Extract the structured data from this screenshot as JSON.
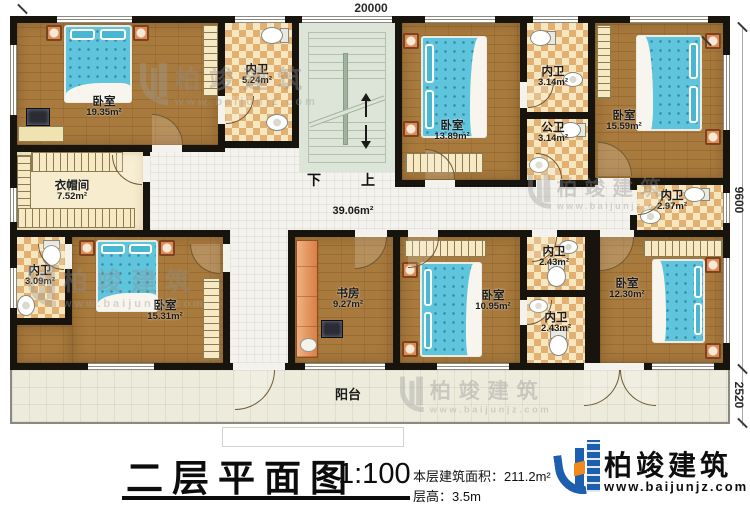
{
  "meta": {
    "drawing_type": "floor-plan"
  },
  "dimensions": {
    "width": "20000",
    "height_main": "9600",
    "height_balcony": "2520"
  },
  "stairs": {
    "down_label": "下",
    "up_label": "上"
  },
  "hall": {
    "area": "39.06m²"
  },
  "balcony": {
    "label": "阳台"
  },
  "watermark": {
    "brand": "柏竣建筑",
    "url": "www.baijunjz.com"
  },
  "title_block": {
    "title": "二层平面图",
    "scale": "1:100",
    "area_line": "本层建筑面积：211.2m²",
    "height_line": "层高：3.5m",
    "brand": "柏竣建筑",
    "brand_url": "www.baijunjz.com"
  },
  "colors": {
    "brand_blue": "#1d5fae",
    "brand_orange": "#f2891f",
    "wall": "#17130d",
    "wood_floor": "#a87a3d"
  },
  "plan": {
    "floors": [
      {
        "c": "whitetile",
        "r": [
          150,
          145,
          487,
          92
        ],
        "n": "hallway-floor"
      },
      {
        "c": "whitetile",
        "r": [
          230,
          237,
          58,
          126
        ],
        "n": "corridor-floor"
      },
      {
        "c": "wood",
        "r": [
          17,
          325,
          55,
          38
        ],
        "n": "bedroom-bl-floor-extension"
      }
    ],
    "rooms": [
      {
        "id": "bedroom-tl",
        "name": "卧室",
        "area": "19.35m²",
        "c": "wood",
        "r": [
          17,
          23,
          201,
          122
        ],
        "lx": 104,
        "ly": 96
      },
      {
        "id": "bath-524",
        "name": "内卫",
        "area": "5.24m²",
        "c": "checker",
        "r": [
          225,
          23,
          67,
          118
        ],
        "lx": 257,
        "ly": 64
      },
      {
        "id": "bedroom-1389",
        "name": "卧室",
        "area": "13.89m²",
        "c": "wood",
        "r": [
          402,
          23,
          118,
          157
        ],
        "lx": 452,
        "ly": 120
      },
      {
        "id": "bath-314-inner",
        "name": "内卫",
        "area": "3.14m²",
        "c": "checker",
        "r": [
          527,
          23,
          61,
          89
        ],
        "lx": 553,
        "ly": 66
      },
      {
        "id": "bath-314-public",
        "name": "公卫",
        "area": "3.14m²",
        "c": "checker",
        "r": [
          527,
          119,
          61,
          61
        ],
        "lx": 553,
        "ly": 122
      },
      {
        "id": "bedroom-1559",
        "name": "卧室",
        "area": "15.59m²",
        "c": "wood",
        "r": [
          595,
          23,
          128,
          155
        ],
        "lx": 624,
        "ly": 110
      },
      {
        "id": "closet",
        "name": "衣帽间",
        "area": "7.52m²",
        "c": "cream",
        "r": [
          17,
          152,
          126,
          78
        ],
        "lx": 72,
        "ly": 180
      },
      {
        "id": "bath-297",
        "name": "内卫",
        "area": "2.97m²",
        "c": "checker",
        "r": [
          637,
          185,
          86,
          45
        ],
        "lx": 672,
        "ly": 190
      },
      {
        "id": "bath-309",
        "name": "内卫",
        "area": "3.09m²",
        "c": "checker",
        "r": [
          17,
          237,
          48,
          81
        ],
        "lx": 40,
        "ly": 265
      },
      {
        "id": "bedroom-1531",
        "name": "卧室",
        "area": "15.31m²",
        "c": "wood",
        "r": [
          72,
          237,
          151,
          126
        ],
        "lx": 165,
        "ly": 300
      },
      {
        "id": "study",
        "name": "书房",
        "area": "9.27m²",
        "c": "wood",
        "r": [
          295,
          237,
          98,
          126
        ],
        "lx": 348,
        "ly": 288
      },
      {
        "id": "bedroom-1095",
        "name": "卧室",
        "area": "10.95m²",
        "c": "wood",
        "r": [
          400,
          237,
          120,
          126
        ],
        "lx": 493,
        "ly": 290
      },
      {
        "id": "bath-243-upper",
        "name": "内卫",
        "area": "2.43m²",
        "c": "checker",
        "r": [
          527,
          237,
          58,
          53
        ],
        "lx": 554,
        "ly": 246
      },
      {
        "id": "bath-243-lower",
        "name": "内卫",
        "area": "2.43m²",
        "c": "checker",
        "r": [
          527,
          297,
          58,
          66
        ],
        "lx": 556,
        "ly": 312
      },
      {
        "id": "bedroom-1230",
        "name": "卧室",
        "area": "12.30m²",
        "c": "wood",
        "r": [
          600,
          237,
          123,
          126
        ],
        "lx": 627,
        "ly": 278
      }
    ],
    "walls": [
      [
        10,
        16,
        720,
        7
      ],
      [
        10,
        363,
        720,
        7
      ],
      [
        10,
        16,
        7,
        354
      ],
      [
        723,
        16,
        7,
        354
      ],
      [
        218,
        16,
        7,
        136
      ],
      [
        292,
        16,
        7,
        131
      ],
      [
        395,
        16,
        7,
        171
      ],
      [
        520,
        16,
        7,
        171
      ],
      [
        588,
        16,
        7,
        171
      ],
      [
        143,
        145,
        7,
        92
      ],
      [
        223,
        230,
        7,
        140
      ],
      [
        288,
        230,
        7,
        140
      ],
      [
        393,
        230,
        7,
        140
      ],
      [
        520,
        230,
        7,
        140
      ],
      [
        585,
        230,
        15,
        140
      ],
      [
        630,
        178,
        7,
        59
      ],
      [
        65,
        237,
        7,
        88
      ],
      [
        10,
        145,
        215,
        7
      ],
      [
        225,
        141,
        74,
        7
      ],
      [
        10,
        230,
        220,
        7
      ],
      [
        288,
        230,
        112,
        7
      ],
      [
        395,
        180,
        132,
        7
      ],
      [
        527,
        112,
        61,
        7
      ],
      [
        527,
        180,
        68,
        7
      ],
      [
        595,
        178,
        135,
        7
      ],
      [
        400,
        230,
        330,
        7
      ],
      [
        527,
        290,
        58,
        7
      ],
      [
        10,
        318,
        62,
        7
      ]
    ],
    "windows": [
      [
        57,
        16,
        75,
        7
      ],
      [
        235,
        16,
        50,
        7
      ],
      [
        302,
        16,
        90,
        7
      ],
      [
        425,
        16,
        70,
        7
      ],
      [
        533,
        16,
        45,
        7
      ],
      [
        630,
        16,
        78,
        7
      ],
      [
        10,
        45,
        7,
        70
      ],
      [
        10,
        188,
        7,
        34
      ],
      [
        10,
        268,
        7,
        40
      ],
      [
        723,
        55,
        7,
        75
      ],
      [
        723,
        193,
        7,
        30
      ],
      [
        723,
        258,
        7,
        85
      ],
      [
        88,
        363,
        66,
        7
      ],
      [
        305,
        363,
        80,
        7
      ],
      [
        437,
        363,
        72,
        7
      ],
      [
        652,
        363,
        62,
        7
      ]
    ],
    "gaps": [
      [
        152,
        145,
        30,
        7
      ],
      [
        143,
        156,
        7,
        26
      ],
      [
        218,
        96,
        7,
        28
      ],
      [
        425,
        180,
        30,
        7
      ],
      [
        520,
        82,
        7,
        26
      ],
      [
        536,
        180,
        24,
        7
      ],
      [
        598,
        178,
        32,
        7
      ],
      [
        630,
        190,
        7,
        25
      ],
      [
        223,
        244,
        7,
        28
      ],
      [
        65,
        244,
        7,
        25
      ],
      [
        355,
        230,
        32,
        7
      ],
      [
        408,
        230,
        30,
        7
      ],
      [
        532,
        230,
        25,
        7
      ],
      [
        520,
        300,
        7,
        25
      ],
      [
        600,
        230,
        34,
        7
      ],
      [
        233,
        363,
        52,
        7
      ],
      [
        584,
        363,
        60,
        7
      ]
    ],
    "arcs": [
      {
        "q": "q-tr",
        "r": [
          152,
          114,
          31,
          31
        ],
        "n": "door-bedroom-tl"
      },
      {
        "q": "q-bl",
        "r": [
          112,
          155,
          30,
          30
        ],
        "n": "door-closet"
      },
      {
        "q": "q-br",
        "r": [
          226,
          96,
          28,
          28
        ],
        "n": "door-bath-524"
      },
      {
        "q": "q-tr",
        "r": [
          425,
          149,
          30,
          30
        ],
        "n": "door-bedroom-1389"
      },
      {
        "q": "q-br",
        "r": [
          528,
          82,
          26,
          26
        ],
        "n": "door-bath-314-inner"
      },
      {
        "q": "q-tr",
        "r": [
          536,
          153,
          26,
          26
        ],
        "n": "door-bath-314-public"
      },
      {
        "q": "q-tr",
        "r": [
          598,
          142,
          34,
          34
        ],
        "n": "door-bedroom-1559"
      },
      {
        "q": "q-br",
        "r": [
          638,
          189,
          26,
          26
        ],
        "n": "door-bath-297"
      },
      {
        "q": "q-bl",
        "r": [
          190,
          244,
          30,
          30
        ],
        "n": "door-bedroom-1531"
      },
      {
        "q": "q-bl",
        "r": [
          38,
          244,
          26,
          26
        ],
        "n": "door-bath-309"
      },
      {
        "q": "q-br",
        "r": [
          355,
          237,
          32,
          32
        ],
        "n": "door-study"
      },
      {
        "q": "q-br",
        "r": [
          408,
          237,
          31,
          31
        ],
        "n": "door-bedroom-1095"
      },
      {
        "q": "q-br",
        "r": [
          532,
          237,
          25,
          25
        ],
        "n": "door-bath-243-upper"
      },
      {
        "q": "q-br",
        "r": [
          527,
          300,
          25,
          25
        ],
        "n": "door-bath-243-lower"
      },
      {
        "q": "q-br",
        "r": [
          600,
          237,
          34,
          34
        ],
        "n": "door-bedroom-1230"
      },
      {
        "q": "q-br",
        "r": [
          235,
          370,
          40,
          40
        ],
        "n": "door-balcony-left"
      },
      {
        "q": "q-br",
        "r": [
          584,
          370,
          36,
          36
        ],
        "n": "door-balcony-right-a"
      },
      {
        "q": "q-bl",
        "r": [
          620,
          370,
          36,
          36
        ],
        "n": "door-balcony-right-b"
      }
    ],
    "furniture": [
      {
        "t": "stand",
        "r": [
          46,
          25,
          16,
          16
        ]
      },
      {
        "t": "stand",
        "r": [
          133,
          25,
          16,
          16
        ]
      },
      {
        "t": "bed",
        "o": "n",
        "r": [
          64,
          25,
          68,
          78
        ]
      },
      {
        "t": "monitor",
        "r": [
          26,
          108,
          24,
          18
        ]
      },
      {
        "t": "desk",
        "r": [
          18,
          126,
          46,
          16
        ]
      },
      {
        "t": "hatch-v",
        "r": [
          203,
          25,
          15,
          72
        ]
      },
      {
        "t": "toilet-h",
        "r": [
          261,
          27,
          28,
          15
        ]
      },
      {
        "t": "sink",
        "r": [
          266,
          114,
          22,
          17
        ]
      },
      {
        "t": "stand",
        "r": [
          403,
          33,
          16,
          16
        ]
      },
      {
        "t": "stand",
        "r": [
          403,
          121,
          16,
          16
        ]
      },
      {
        "t": "bed",
        "o": "w",
        "r": [
          421,
          36,
          66,
          102
        ]
      },
      {
        "t": "hatch-h",
        "r": [
          405,
          153,
          78,
          20
        ]
      },
      {
        "t": "toilet-h",
        "r": [
          530,
          30,
          26,
          14
        ]
      },
      {
        "t": "sink",
        "r": [
          563,
          72,
          20,
          15
        ]
      },
      {
        "t": "toilet-h",
        "r": [
          560,
          122,
          26,
          14
        ]
      },
      {
        "t": "sink",
        "r": [
          529,
          157,
          20,
          16
        ]
      },
      {
        "t": "stand",
        "r": [
          705,
          33,
          16,
          16
        ]
      },
      {
        "t": "stand",
        "r": [
          705,
          129,
          16,
          16
        ]
      },
      {
        "t": "bed",
        "o": "e",
        "r": [
          636,
          35,
          66,
          96
        ]
      },
      {
        "t": "hatch-v",
        "r": [
          597,
          25,
          14,
          74
        ]
      },
      {
        "t": "toilet-h",
        "r": [
          684,
          187,
          26,
          13
        ]
      },
      {
        "t": "sink",
        "r": [
          640,
          209,
          21,
          15
        ]
      },
      {
        "t": "hatch-v",
        "r": [
          17,
          155,
          14,
          73
        ]
      },
      {
        "t": "hatch-h",
        "r": [
          31,
          152,
          92,
          20
        ]
      },
      {
        "t": "hatch-h",
        "r": [
          17,
          208,
          118,
          20
        ]
      },
      {
        "t": "toilet-v",
        "r": [
          42,
          240,
          17,
          26
        ]
      },
      {
        "t": "sink",
        "r": [
          17,
          295,
          18,
          21
        ]
      },
      {
        "t": "stand",
        "r": [
          79,
          240,
          16,
          16
        ]
      },
      {
        "t": "stand",
        "r": [
          159,
          240,
          16,
          16
        ]
      },
      {
        "t": "bed",
        "o": "n",
        "r": [
          96,
          240,
          62,
          72
        ]
      },
      {
        "t": "hatch-v",
        "r": [
          203,
          278,
          17,
          82
        ]
      },
      {
        "t": "cabinet",
        "r": [
          296,
          240,
          22,
          118
        ]
      },
      {
        "t": "monitor",
        "r": [
          321,
          320,
          22,
          18
        ]
      },
      {
        "t": "chair",
        "r": [
          300,
          338,
          17,
          14
        ]
      },
      {
        "t": "hatch-h",
        "r": [
          404,
          240,
          82,
          17
        ]
      },
      {
        "t": "stand",
        "r": [
          402,
          262,
          16,
          16
        ]
      },
      {
        "t": "stand",
        "r": [
          402,
          341,
          16,
          16
        ]
      },
      {
        "t": "bed",
        "o": "w",
        "r": [
          420,
          262,
          62,
          95
        ]
      },
      {
        "t": "sink",
        "r": [
          559,
          240,
          19,
          14
        ]
      },
      {
        "t": "toilet-v",
        "r": [
          547,
          261,
          17,
          26
        ]
      },
      {
        "t": "sink",
        "r": [
          529,
          299,
          19,
          14
        ]
      },
      {
        "t": "toilet-v",
        "r": [
          549,
          330,
          17,
          26
        ]
      },
      {
        "t": "hatch-h",
        "r": [
          643,
          240,
          80,
          17
        ]
      },
      {
        "t": "stand",
        "r": [
          705,
          257,
          16,
          16
        ]
      },
      {
        "t": "stand",
        "r": [
          705,
          343,
          16,
          16
        ]
      },
      {
        "t": "bed",
        "o": "e",
        "r": [
          652,
          259,
          53,
          84
        ]
      }
    ]
  }
}
